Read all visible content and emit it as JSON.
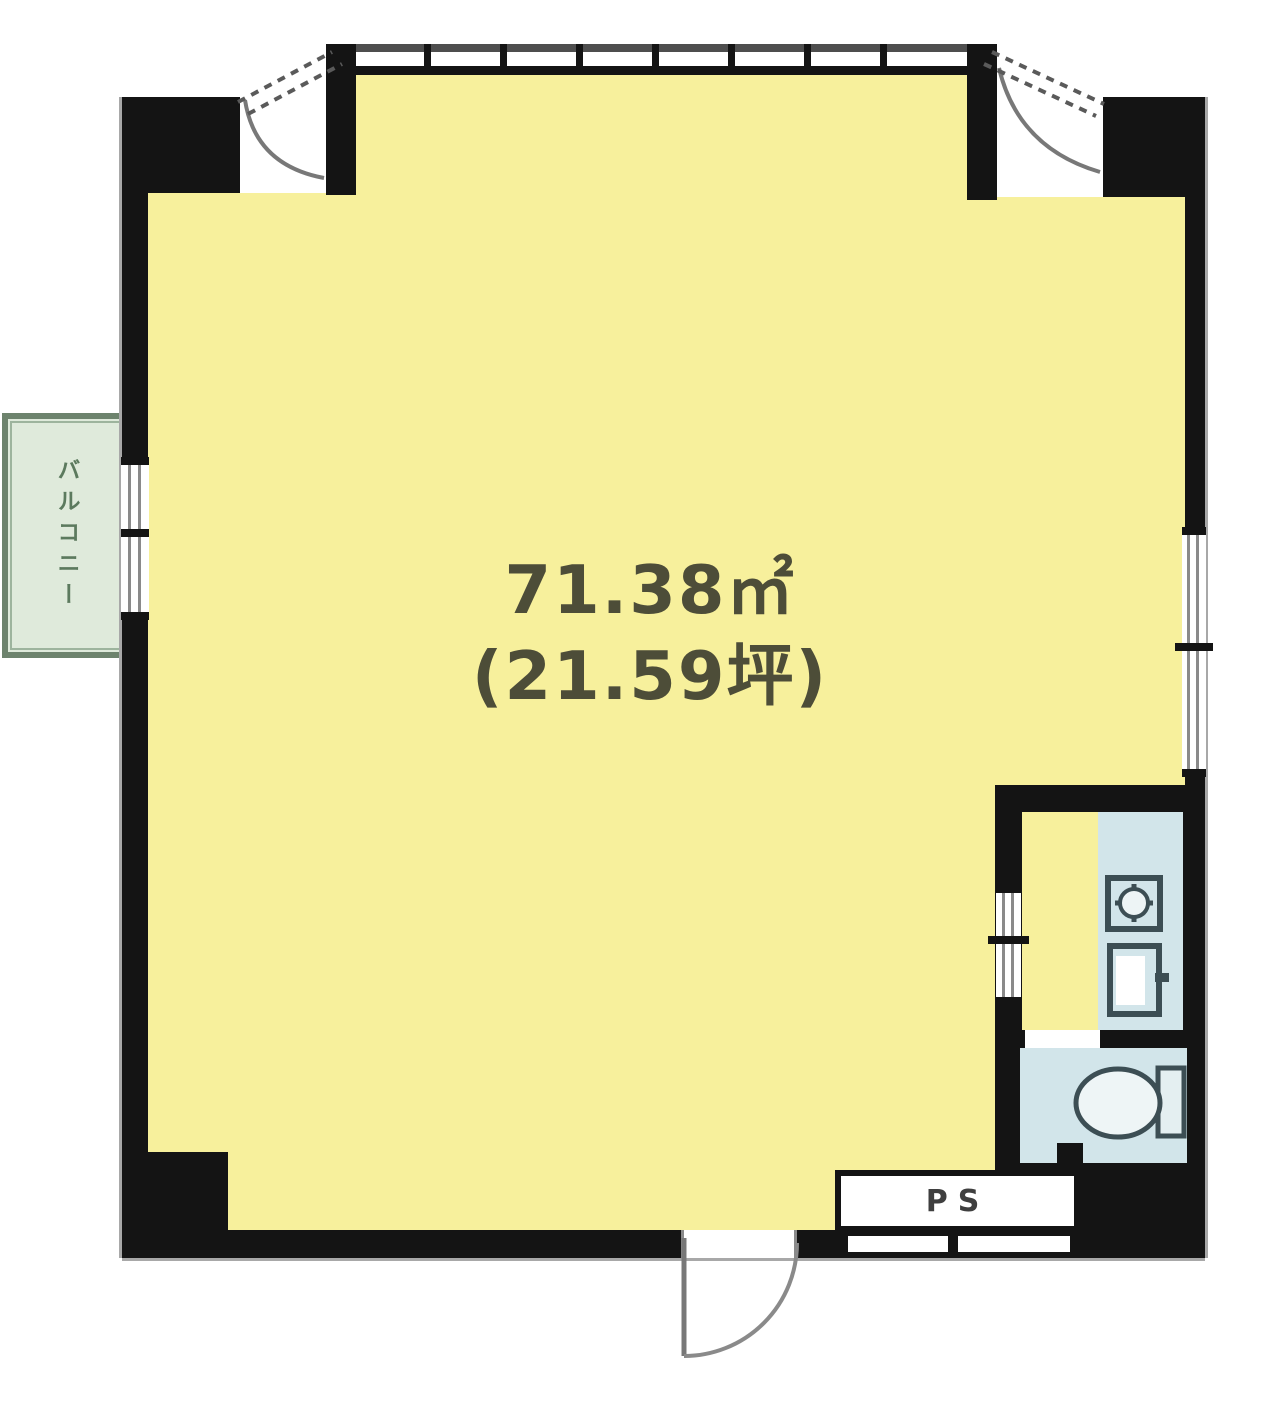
{
  "floor_plan": {
    "main_room": {
      "area_sqm": "71.38㎡",
      "area_tsubo": "(21.59坪)"
    },
    "balcony": {
      "label": "バルコニー"
    },
    "pipe_shaft": {
      "label": "PS"
    },
    "fixtures": [
      {
        "name": "stove-burner-icon",
        "location": "wet-area"
      },
      {
        "name": "kitchen-sink-icon",
        "location": "wet-area"
      },
      {
        "name": "toilet-icon",
        "location": "toilet-room"
      },
      {
        "name": "entry-door-swing-icon",
        "location": "bottom-wall"
      },
      {
        "name": "casement-window-icon",
        "location": "top-left-corner"
      },
      {
        "name": "casement-window-icon",
        "location": "top-right-corner"
      }
    ]
  },
  "colors": {
    "room_fill": "#f7f09c",
    "wall": "#141414",
    "line_gray": "#8a8a8a",
    "band_top": "#4e4e4e",
    "balcony_fill": "#dfeadb",
    "balcony_border": "#6d836d",
    "balcony_text": "#5c7a5e",
    "wet_fill": "#d2e5ea",
    "fixture_stroke": "#3c4e54",
    "label_color": "#4d4d38",
    "ps_label_color": "#3f3f3f"
  }
}
